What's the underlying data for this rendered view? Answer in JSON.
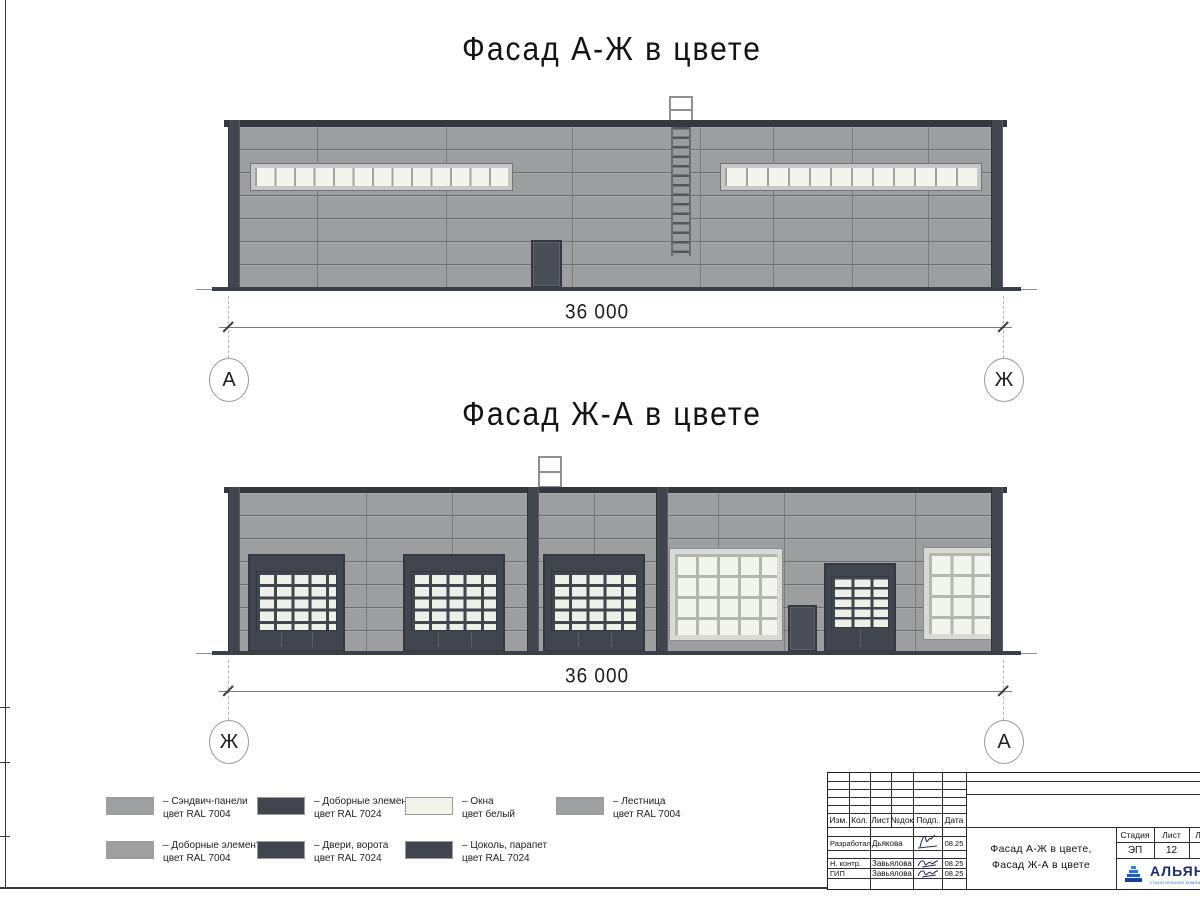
{
  "drawing": {
    "facade_top": {
      "title": "Фасад А-Ж в цвете",
      "dimension": "36 000",
      "axis_left": "А",
      "axis_right": "Ж"
    },
    "facade_bottom": {
      "title": "Фасад Ж-А в цвете",
      "dimension": "36 000",
      "axis_left": "Ж",
      "axis_right": "А"
    }
  },
  "legend": {
    "items": [
      {
        "line1": "– Сэндвич-панели",
        "line2": "цвет RAL 7004",
        "swatch": "#9e9fa1"
      },
      {
        "line1": "– Доборные элементы",
        "line2": "цвет RAL 7024",
        "swatch": "#41454e"
      },
      {
        "line1": "– Окна",
        "line2": "цвет белый",
        "swatch": "#f2f4ea"
      },
      {
        "line1": "– Лестница",
        "line2": "цвет RAL 7004",
        "swatch": "#9e9fa1"
      },
      {
        "line1": "– Доборные элементы",
        "line2": "цвет RAL 7004",
        "swatch": "#9e9fa1"
      },
      {
        "line1": "– Двери, ворота",
        "line2": "цвет RAL 7024",
        "swatch": "#41454e"
      },
      {
        "line1": "– Цоколь, парапет",
        "line2": "цвет RAL 7024",
        "swatch": "#41454e"
      }
    ]
  },
  "titleblock": {
    "cols": {
      "izm": "Изм.",
      "kol": "Кол.",
      "list": "Лист",
      "ndoc": "№док",
      "podp": "Подп.",
      "data": "Дата"
    },
    "rows": [
      {
        "role": "Разработал",
        "name": "Дьякова",
        "date": "08.25"
      },
      {
        "role": "Н. контр.",
        "name": "Завьялова",
        "date": "08.25"
      },
      {
        "role": "ГИП",
        "name": "Завьялова",
        "date": "08.25"
      }
    ],
    "title_line1": "Фасад А-Ж в цвете,",
    "title_line2": "Фасад Ж-А в цвете",
    "stage_label": "Стадия",
    "sheet_label": "Лист",
    "sheets_label": "Листов",
    "stage": "ЭП",
    "sheet": "12",
    "sheets": "2",
    "company": "АЛЬЯНС",
    "company_sub": "строительная компания"
  },
  "colors": {
    "wall": "#9d9ea0",
    "dark": "#41454e",
    "dark2": "#343841",
    "doorin": "#4a4e57",
    "pane": "#f2f5ec",
    "gpane": "#edf0e7",
    "mull": "#b4b6b0",
    "smull": "#a3a4a1",
    "wframe": "#c7c8c5",
    "bframe": "#d8dad3",
    "ground": "#3b3f48",
    "blue": "#2b6fd4",
    "navy": "#1c2f6b"
  }
}
